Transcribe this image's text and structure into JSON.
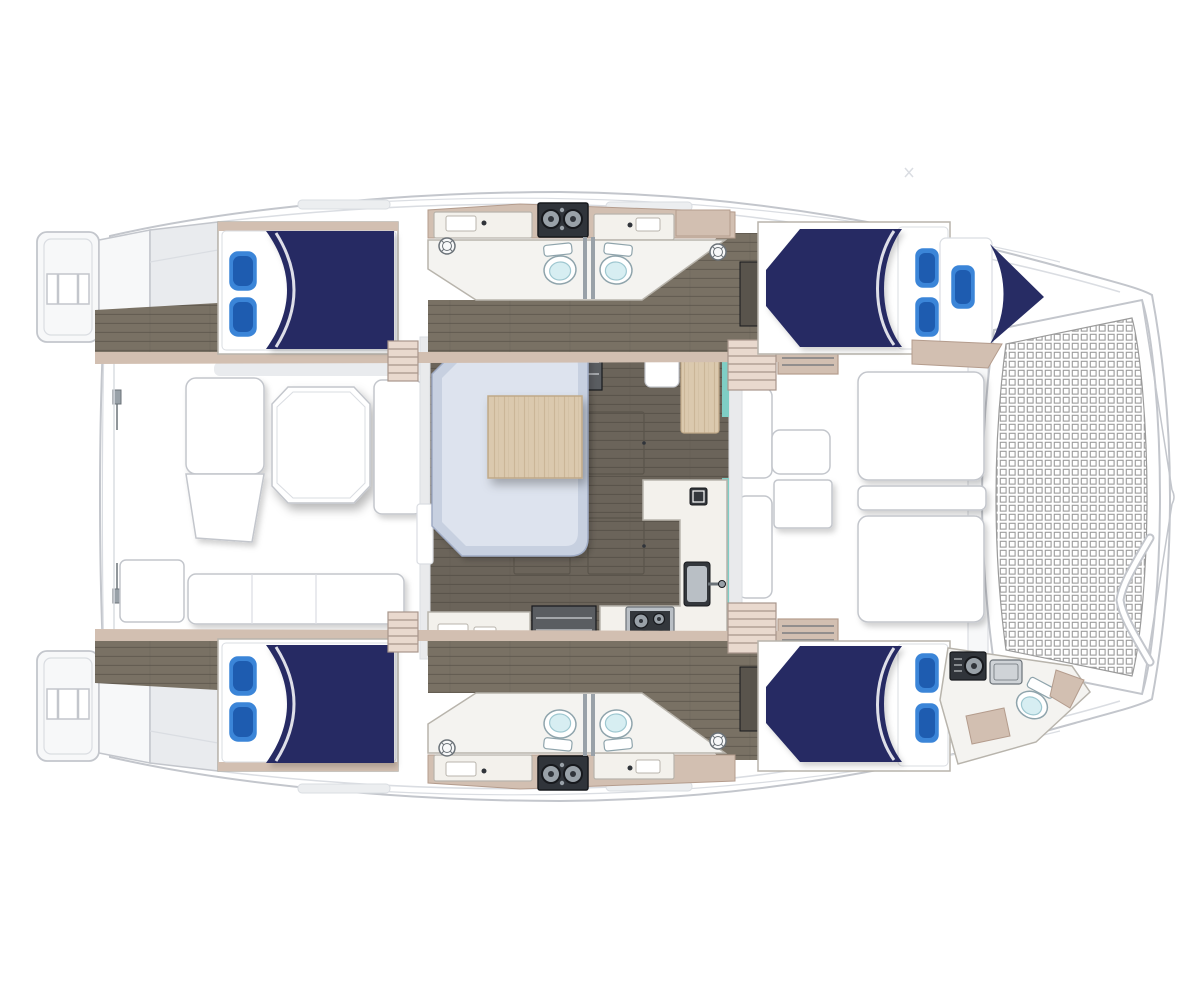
{
  "page": {
    "background": "#ffffff",
    "description": "Top-down floor plan of a sailing catamaran with four double cabins, forepeak berth, central salon with galley, heads with toilets and showers, aft and forward cockpits, twin swim platforms and a bow trampoline"
  },
  "colors": {
    "white": "#ffffff",
    "deck": "#f7f8f9",
    "deck_shadow": "#e9ebee",
    "outline": "#c3c6cc",
    "outline_soft": "#dadde2",
    "navy": "#272c64",
    "pillow": "#3b85d8",
    "pillow_dark": "#1e5cb0",
    "floor": "#6b645a",
    "corridor": "#797164",
    "floor_line": "#5a544b",
    "wood": "#dbc9ae",
    "wood_line": "#c0a988",
    "sofa": "#c7d0e0",
    "sofa_light": "#dde3ee",
    "sofa_line": "#9fabc4",
    "cream": "#f3f1ec",
    "cream_line": "#b8b4ac",
    "bath_floor": "#f4f3f0",
    "tan": "#d2bfb1",
    "tan_dark": "#b49c8d",
    "stair": "#e9d9ce",
    "stair_line": "#a8968c",
    "teal": "#7fcec5",
    "dark": "#30343a",
    "dark_line": "#17191d",
    "steel": "#99a1a8",
    "steel_dark": "#6b7278",
    "bowl": "#d7eef2",
    "bowl_line": "#9ec7d0",
    "toilet_line": "#8fa4ac",
    "grid": "#9b9b9b",
    "step_dark": "#5a5d61",
    "step_tread": "#a3a6aa",
    "wall": "#e9eaec",
    "cabinet_dark": "#59544c",
    "window_gray": "#eceef0",
    "shower_tray": "#cfd3d7",
    "stove_inner": "#33373c",
    "sink_dark": "#33373c",
    "sink_metal": "#b9bfc5"
  },
  "features": {
    "swim_platforms": 2,
    "double_beds": 4,
    "single_berths": 1,
    "pillows_total": 9,
    "toilets": 5,
    "shower_drains": 4,
    "stove_burners": 4,
    "cockpit_tables": 2,
    "sunpads": 2,
    "trampolines": 1
  },
  "areas": [
    {
      "id": "aft-cockpit",
      "label": "aft cockpit with table and benches"
    },
    {
      "id": "salon",
      "label": "salon with L-sofa, table and galley"
    },
    {
      "id": "forward-cockpit",
      "label": "forward cockpit lounge"
    },
    {
      "id": "trampoline",
      "label": "bow trampoline"
    },
    {
      "id": "port-hull",
      "label": "port hull cabins and head"
    },
    {
      "id": "starboard-hull",
      "label": "starboard hull cabins and heads"
    }
  ]
}
